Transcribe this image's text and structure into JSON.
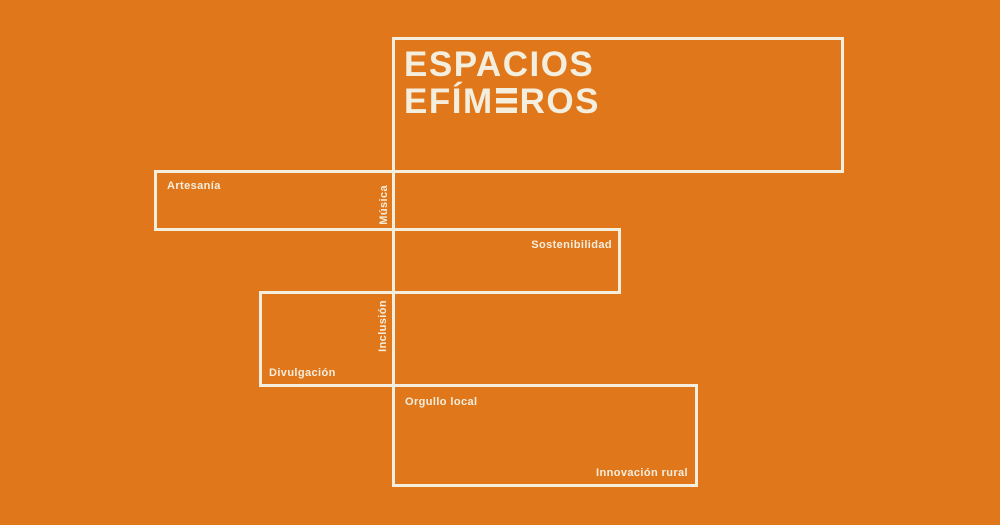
{
  "canvas": {
    "width": 1000,
    "height": 525,
    "background_color": "#E1771B",
    "line_color": "#F4EEDE"
  },
  "title": {
    "full": "ESPACIOS EFÍMEROS",
    "line1": "ESPACIOS",
    "line2_pre": "EFÍM",
    "line2_post": "ROS",
    "stylized_letter": "E"
  },
  "labels": {
    "artesania": "Artesanía",
    "musica": "Música",
    "sostenibilidad": "Sostenibilidad",
    "inclusion": "Inclusión",
    "divulgacion": "Divulgación",
    "orgullo_local": "Orgullo local",
    "innovacion_rural": "Innovación rural"
  }
}
